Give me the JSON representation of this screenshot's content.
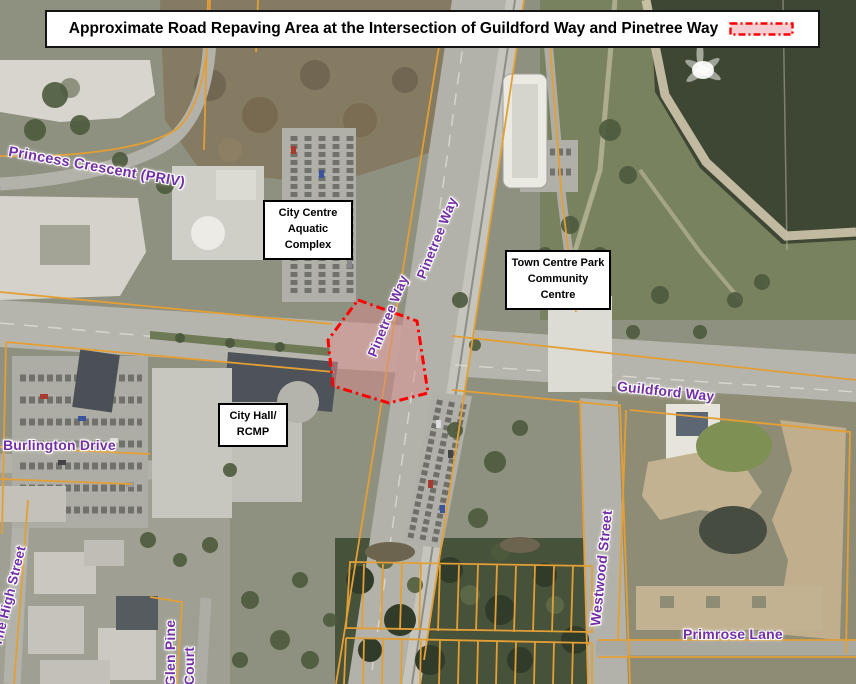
{
  "title": {
    "text": "Approximate Road Repaving Area at the Intersection of Guildford Way and Pinetree Way"
  },
  "legend": {
    "swatch_fill": "#f6cdd1",
    "swatch_stroke": "#ff0000"
  },
  "streets": {
    "princess_crescent": "Princess Crescent (PRIV)",
    "pinetree_way_upper": "Pinetree Way",
    "pinetree_way_lower": "Pinetree Way",
    "guildford_way": "Guildford Way",
    "burlington_drive": "Burlington Drive",
    "westwood_street": "Westwood Street",
    "primrose_lane": "Primrose Lane",
    "the_high_street": "The High Street",
    "glen_pine": "Glen Pine",
    "court": "Court"
  },
  "places": {
    "aquatic_complex": {
      "line1": "City Centre",
      "line2": "Aquatic",
      "line3": "Complex"
    },
    "town_centre_park": {
      "line1": "Town Centre Park",
      "line2": "Community",
      "line3": "Centre"
    },
    "city_hall": {
      "line1": "City Hall/",
      "line2": "RCMP"
    }
  },
  "colors": {
    "label_purple": "#7330a6",
    "repave_stroke": "#ff0000",
    "repave_fill": "#d98c8c",
    "parcel_line": "#e39f35",
    "water": "#3e4734"
  }
}
